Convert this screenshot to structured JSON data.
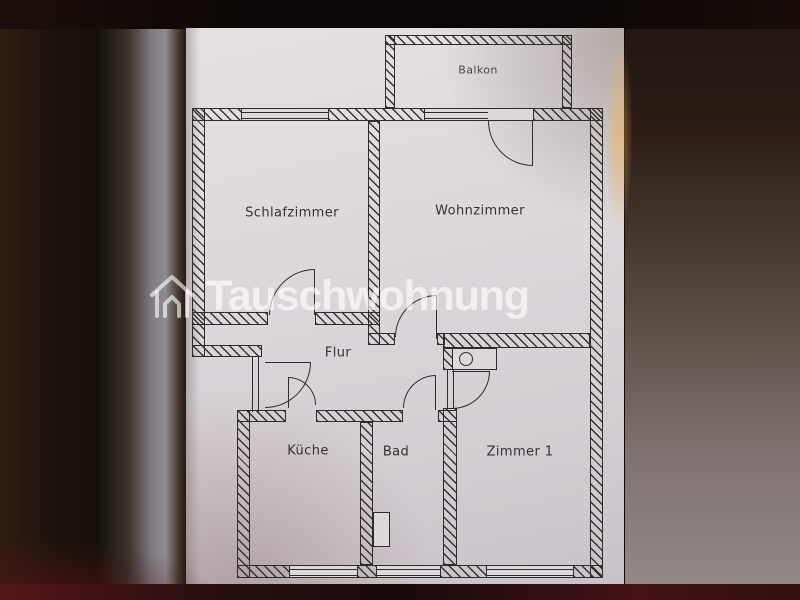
{
  "watermark": {
    "brand": "Tauschwohnung",
    "icon": "house-icon",
    "color": "#ffffff",
    "opacity": 0.62
  },
  "floor_plan": {
    "rooms": [
      {
        "id": "balkon",
        "label": "Balkon"
      },
      {
        "id": "schlafzimmer",
        "label": "Schlafzimmer"
      },
      {
        "id": "wohnzimmer",
        "label": "Wohnzimmer"
      },
      {
        "id": "flur",
        "label": "Flur"
      },
      {
        "id": "kueche",
        "label": "Küche"
      },
      {
        "id": "bad",
        "label": "Bad"
      },
      {
        "id": "zimmer-1",
        "label": "Zimmer 1"
      }
    ],
    "fixtures": [
      {
        "id": "wc-basin",
        "name": "wc-basin-fixture"
      },
      {
        "id": "bath-wc",
        "name": "bath-wc-fixture"
      }
    ],
    "elements": {
      "wall_style": "hatched",
      "windows": 5,
      "doors": 7
    }
  },
  "colors": {
    "paper": "#d9d4d8",
    "ink": "#2e2b2c",
    "background": "#150e0a"
  }
}
